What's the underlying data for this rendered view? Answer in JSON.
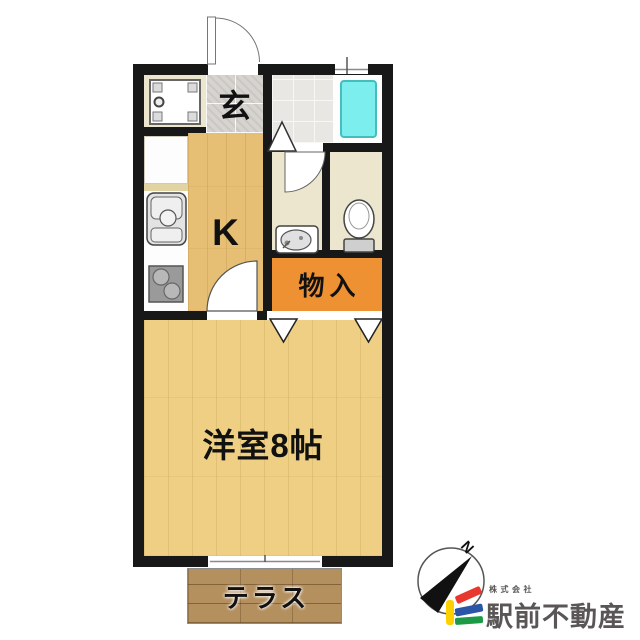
{
  "floorplan": {
    "labels": {
      "entrance": "玄",
      "kitchen": "K",
      "storage": "物入",
      "western_room": "洋室8帖",
      "terrace": "テラス"
    }
  },
  "compass": {
    "north": "N"
  },
  "branding": {
    "company_prefix": "株式会社",
    "company_name": "駅前不動産"
  },
  "colors": {
    "wall": "#181818",
    "kitchen_floor": "#e7bf74",
    "western_floor": "#eecf83",
    "storage_fill": "#ee9133",
    "tub_fill": "#7deeee",
    "tub_border": "#45bdbd",
    "cream_room": "#ebe6cd",
    "entrance_tile": "#d7d4d0",
    "bath_tile": "#e8e7e3",
    "terrace_floor": "#b5905f",
    "logo_yellow": "#fdd000",
    "logo_red": "#e8382d",
    "logo_blue": "#2b55a7",
    "logo_green": "#1c9a44",
    "brand_text": "#5a5656"
  }
}
